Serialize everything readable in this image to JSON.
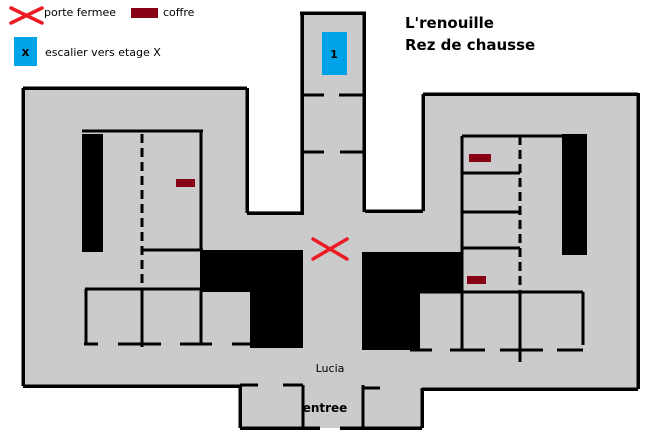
{
  "title": {
    "line1": "L'renouille",
    "line2": "Rez de chausse"
  },
  "legend": {
    "closed_door": {
      "label": "porte fermee"
    },
    "chest": {
      "label": "coffre"
    },
    "stairs": {
      "label": "escalier vers etage X",
      "symbol": "x"
    }
  },
  "map": {
    "stairs_floor_label": "1",
    "hall_label": "Lucia",
    "entrance_label": "entree"
  },
  "colors": {
    "background": "#ffffff",
    "floor": "#cbcbcb",
    "wall": "#000000",
    "closed_door": "#ed1c24",
    "chest": "#880015",
    "stairs": "#00a2e8"
  }
}
